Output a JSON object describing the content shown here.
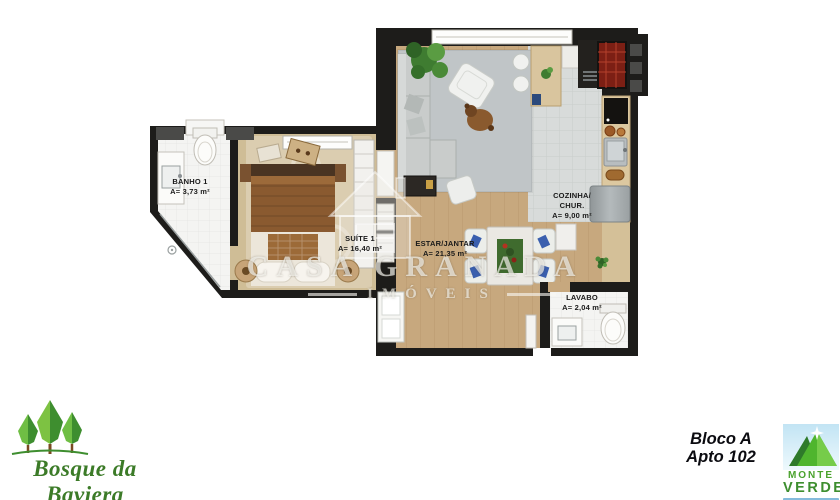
{
  "plan": {
    "rooms": [
      {
        "id": "banho-1",
        "name": "BANHO 1",
        "area": "A= 3,73 m²"
      },
      {
        "id": "suite-1",
        "name": "SUÍTE 1",
        "area": "A= 16,40 m²"
      },
      {
        "id": "estar-jantar",
        "name": "ESTAR/JANTAR",
        "area": "A= 21,35 m²"
      },
      {
        "id": "cozinha-chur",
        "name_line1": "COZINHA/",
        "name_line2": "CHUR.",
        "area": "A= 9,00 m²"
      },
      {
        "id": "lavabo",
        "name": "LAVABO",
        "area": "A= 2,04 m²"
      }
    ]
  },
  "watermark": {
    "brand": "CASA GRANADA",
    "subtitle": "IMÓVEIS"
  },
  "footer": {
    "development_name": "Bosque da Baviera",
    "unit": {
      "block": "Bloco A",
      "apartment": "Apto 102"
    },
    "builder": {
      "word1": "MONTE",
      "word2": "VERDE"
    }
  },
  "colors": {
    "wall": "#1d1c1a",
    "wood_floor": "#c7a87e",
    "suite_floor": "#cfbd96",
    "kitchen_tile": "#d8dbda",
    "counter_tan": "#d9c59e",
    "rug_gray": "#c0c5c7",
    "bathroom_tile": "#f4f4f2",
    "watermark_text": "rgba(248,247,242,0.65)",
    "bosque_green": "#3c7b28",
    "monteverde_green": "#4fb52e",
    "monteverde_bar_blue": "#85bbdc",
    "label_text": "#1a1a1a"
  }
}
